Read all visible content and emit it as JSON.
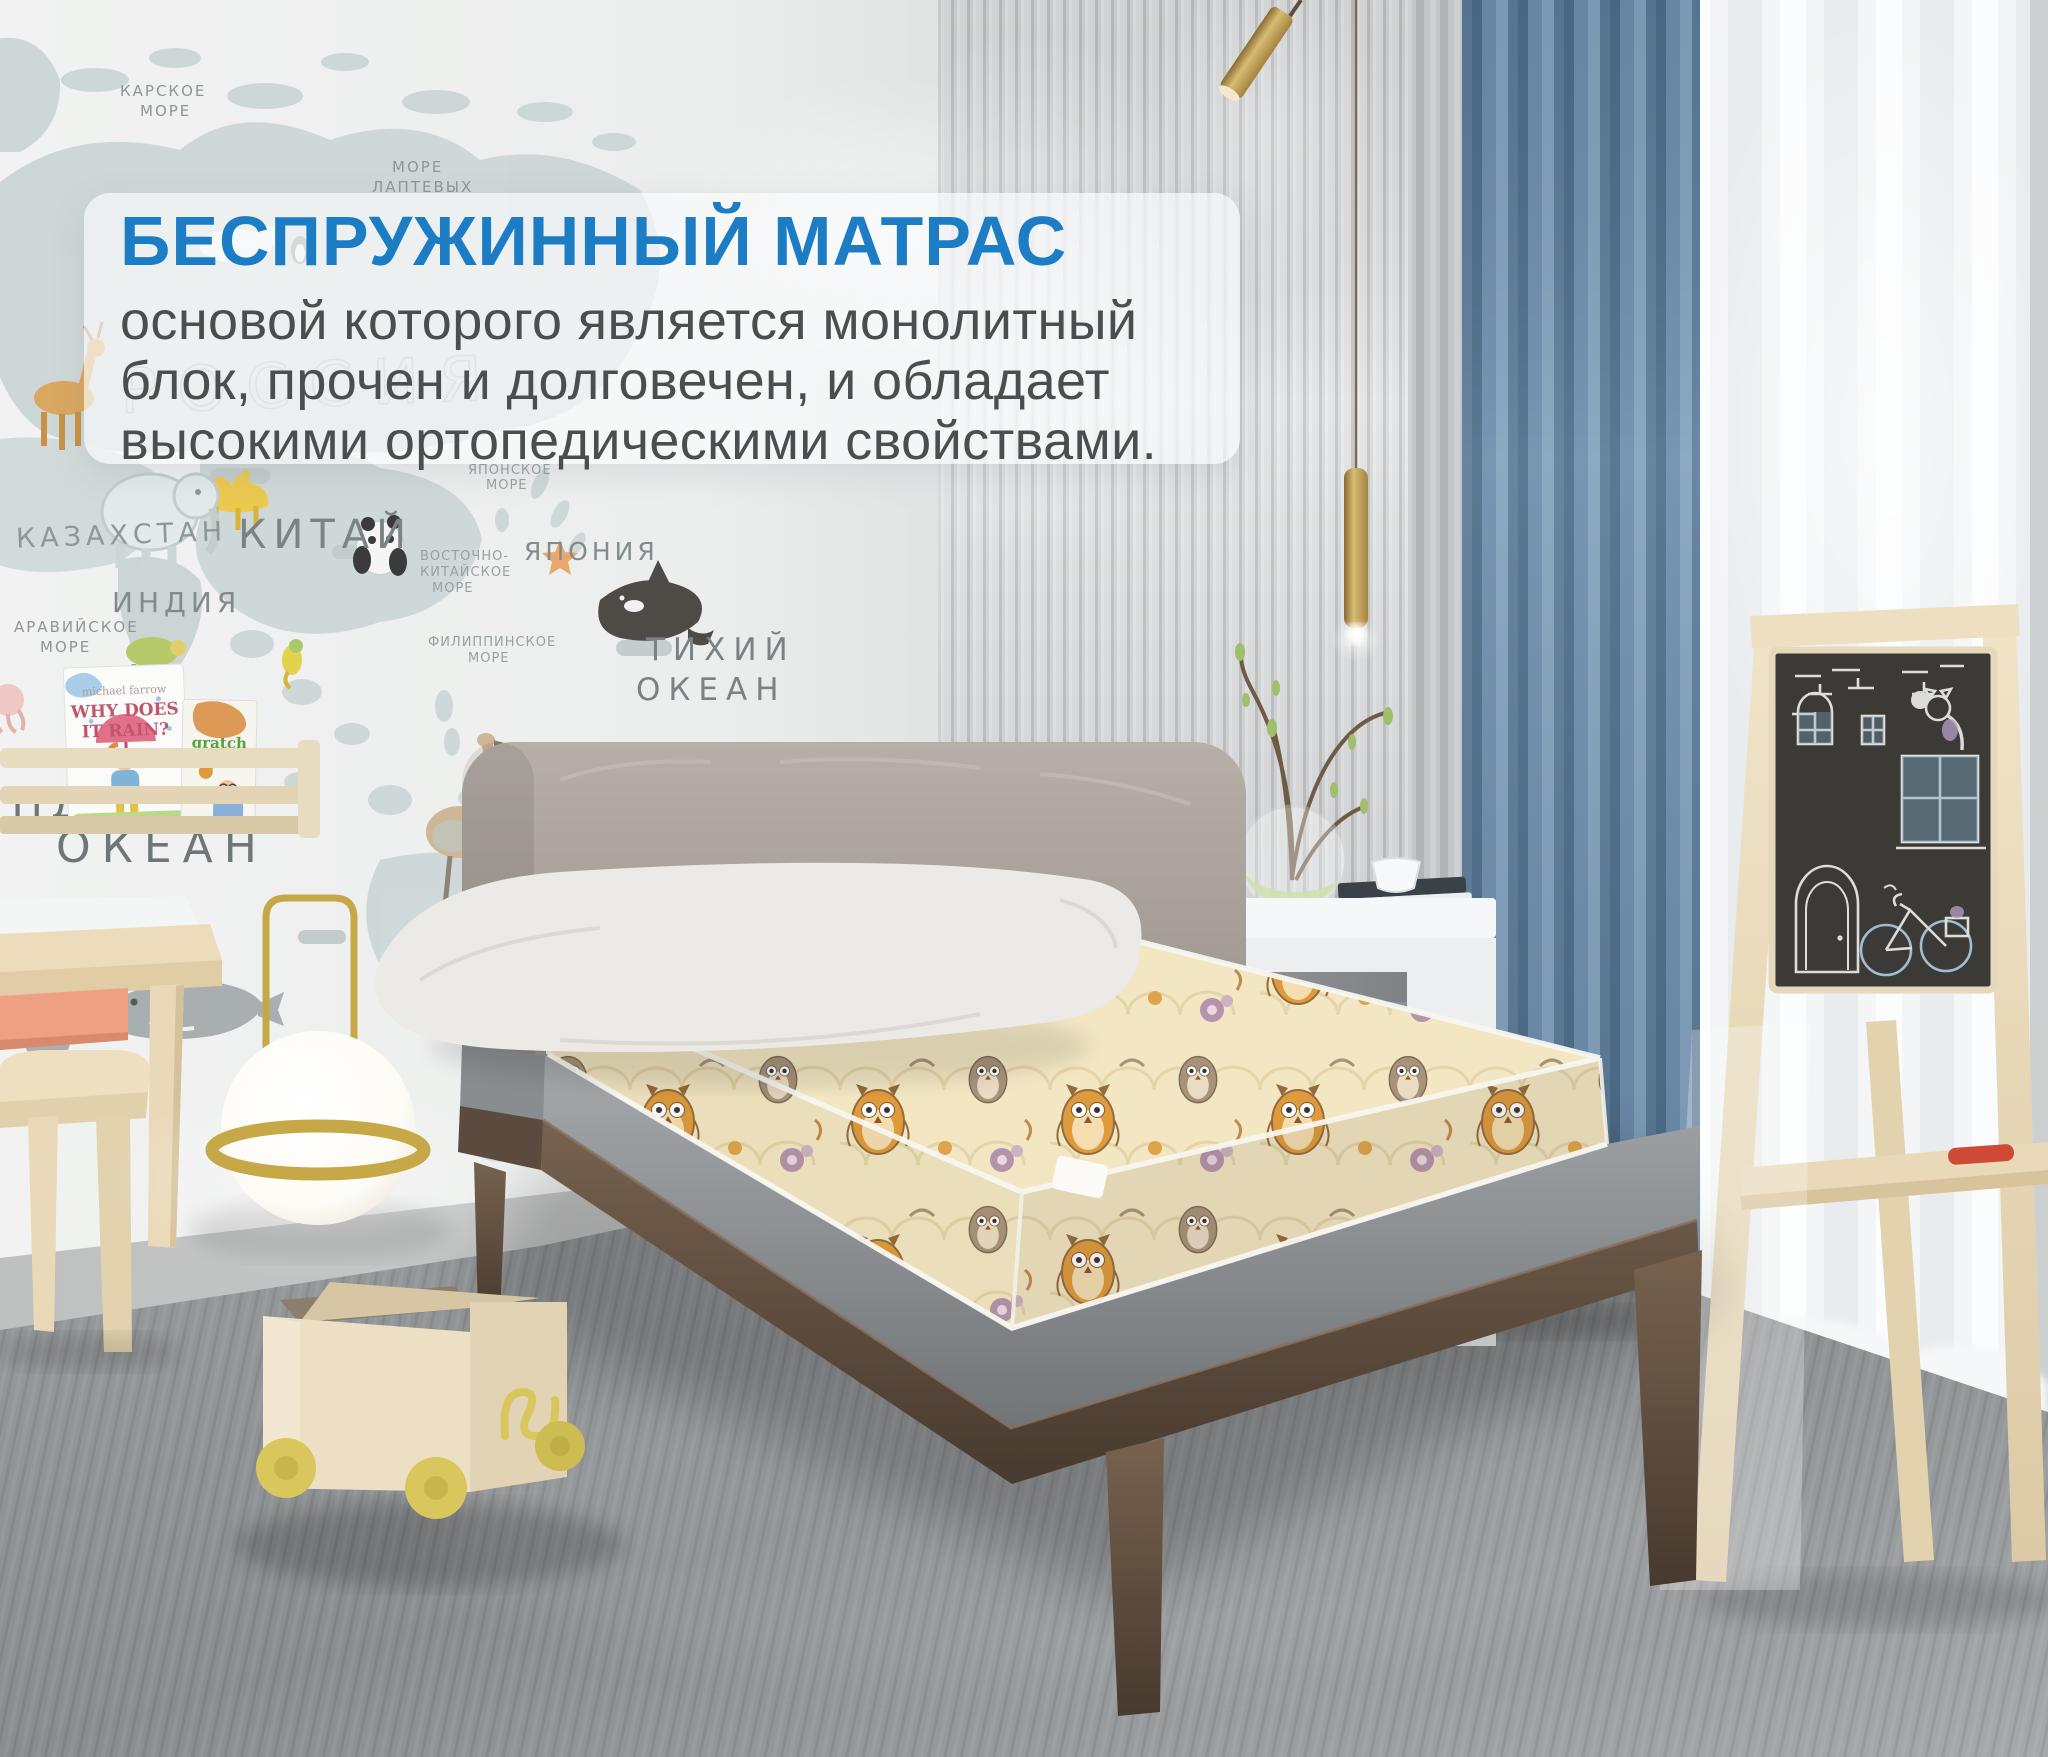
{
  "promo": {
    "title": "БЕСПРУЖИННЫЙ МАТРАС",
    "line1": "основой которого является монолитный",
    "line2": "блок, прочен и долговечен, и обладает",
    "line3": "высокими ортопедическими свойствами.",
    "title_color": "#1d7dc4",
    "body_color": "#4c4d4f",
    "panel_bg": "rgba(251,252,253,0.66)"
  },
  "map_labels": {
    "kara1": "КАРСКОЕ",
    "kara2": "МОРЕ",
    "laptev1": "МОРЕ",
    "laptev2": "ЛАПТЕВЫХ",
    "russia": "РОССИЯ",
    "kazakhstan": "КАЗАХСТАН",
    "china": "КИТАЙ",
    "japan": "ЯПОНИЯ",
    "japan_sea1": "ЯПОНСКОЕ",
    "japan_sea2": "МОРЕ",
    "east_china1": "ВОСТОЧНО-",
    "east_china2": "КИТАЙСКОЕ",
    "east_china3": "МОРЕ",
    "india": "ИНДИЯ",
    "arabian1": "АРАВИЙСКОЕ",
    "arabian2": "МОРЕ",
    "philippine1": "ФИЛИППИНСКОЕ",
    "philippine2": "МОРЕ",
    "pacific1": "ТИХИЙ",
    "pacific2": "ОКЕАН",
    "ocean": "ОКЕАН",
    "indian_partial": "ИНД",
    "abc": "ABC"
  },
  "shelf_books": {
    "book1_author": "michael farrow",
    "book1_title_line1": "WHY DOES",
    "book1_title_line2": "IT RAIN?",
    "book2_text1": "gratch",
    "book2_text2": "butterfly"
  },
  "palette": {
    "accent_blue": "#1d7dc4",
    "curtain_blue": "#64859f",
    "mattress_cream": "#f3e7c3",
    "owl_orange": "#df9a3c",
    "walnut_wood": "#5f4c3e",
    "birch_wood": "#ead9b9",
    "wheel_yellow": "#d9c75e",
    "rug_gray": "#8c8f91",
    "panel_gray": "#d6d8d9"
  }
}
